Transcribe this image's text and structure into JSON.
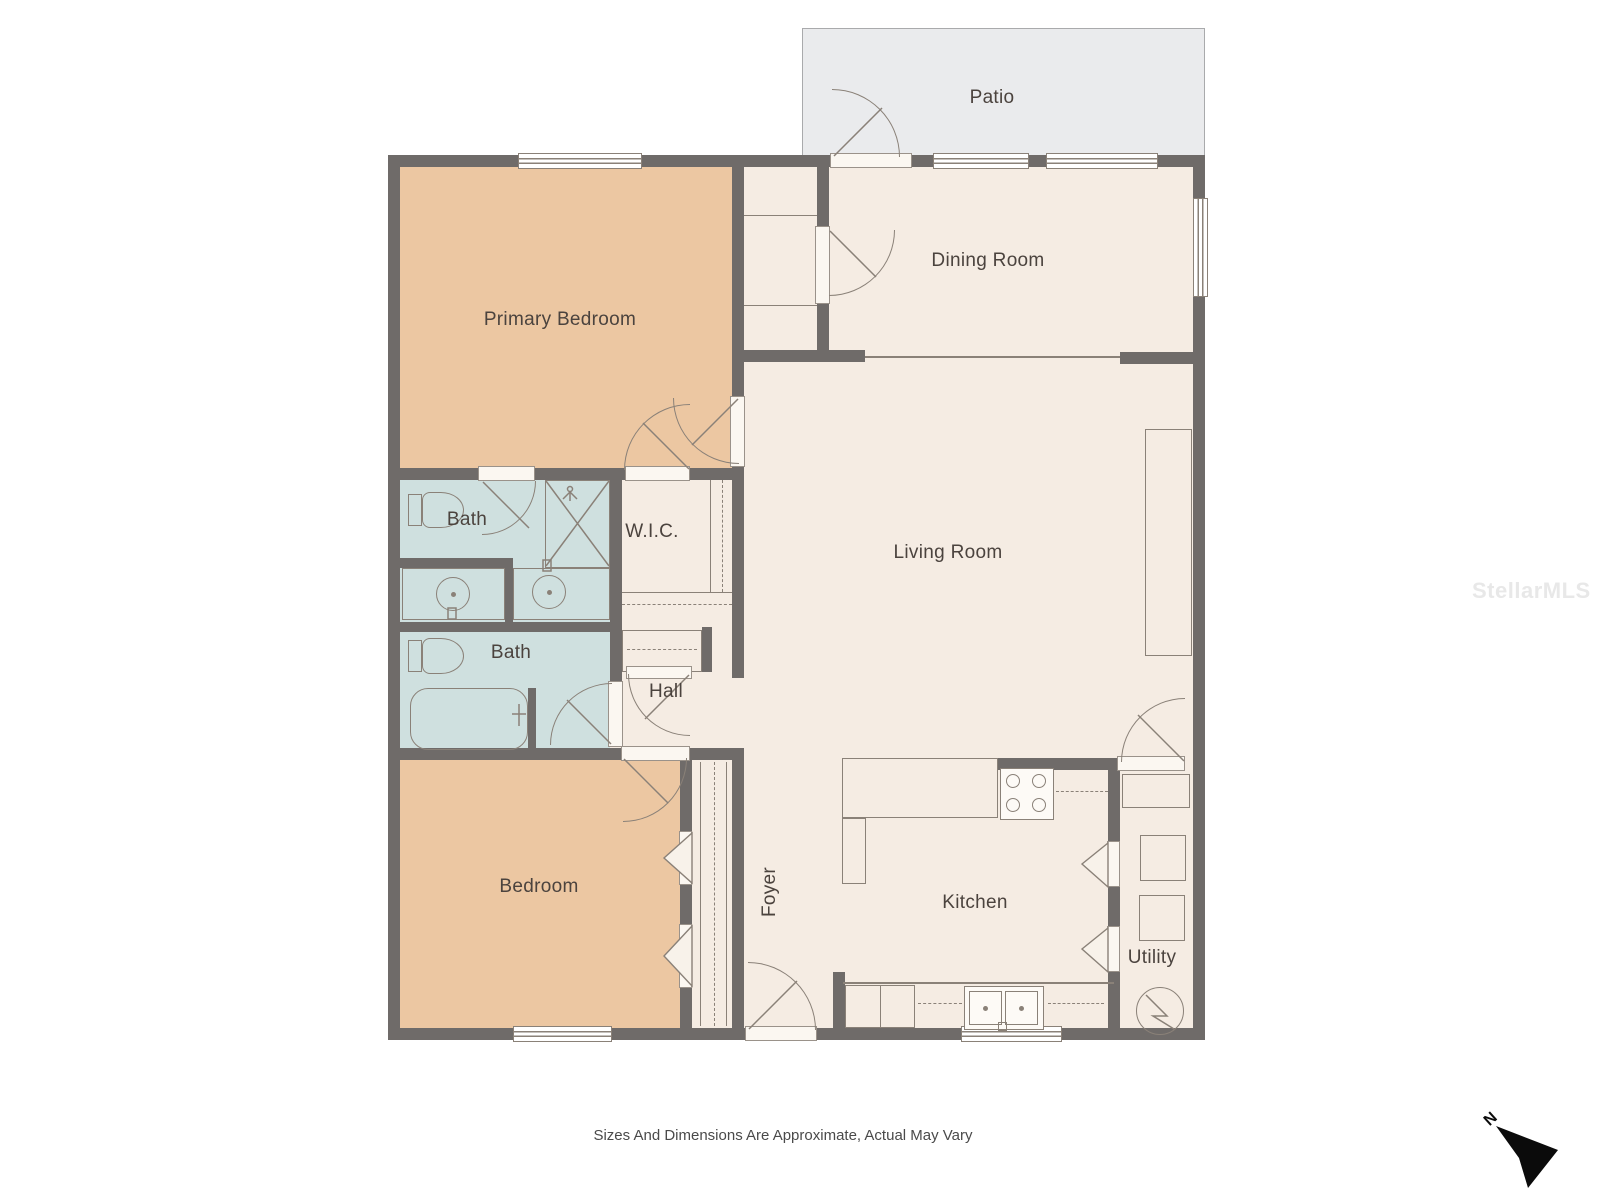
{
  "rooms": [
    {
      "id": "patio",
      "label": "Patio"
    },
    {
      "id": "primary-bedroom",
      "label": "Primary Bedroom"
    },
    {
      "id": "dining-room",
      "label": "Dining Room"
    },
    {
      "id": "living-room",
      "label": "Living Room"
    },
    {
      "id": "bath-upper",
      "label": "Bath"
    },
    {
      "id": "wic",
      "label": "W.I.C."
    },
    {
      "id": "bath-lower",
      "label": "Bath"
    },
    {
      "id": "hall",
      "label": "Hall"
    },
    {
      "id": "bedroom",
      "label": "Bedroom"
    },
    {
      "id": "foyer",
      "label": "Foyer"
    },
    {
      "id": "kitchen",
      "label": "Kitchen"
    },
    {
      "id": "utility",
      "label": "Utility"
    }
  ],
  "compass": {
    "label": "N"
  },
  "watermark": {
    "text": "StellarMLS"
  },
  "footer": {
    "disclaimer": "Sizes And Dimensions Are Approximate, Actual May Vary"
  },
  "colors": {
    "wall": "#6f6b69",
    "fixture_line": "#8a8178",
    "floor": "#f5ece3",
    "bedroom_fill": "#ecc7a2",
    "bath_fill": "#cfe0df",
    "patio_fill": "#eaebed",
    "patio_border": "#a9aaac",
    "label_text": "#4b433e",
    "compass_arrow": "#0b0b0b",
    "watermark_text": "#e8e8e8"
  },
  "fixtures": [
    "toilet",
    "sink",
    "shower",
    "bathtub",
    "stove",
    "kitchen-sink",
    "washer",
    "dryer",
    "water-heater",
    "closet-shelf",
    "counter"
  ]
}
